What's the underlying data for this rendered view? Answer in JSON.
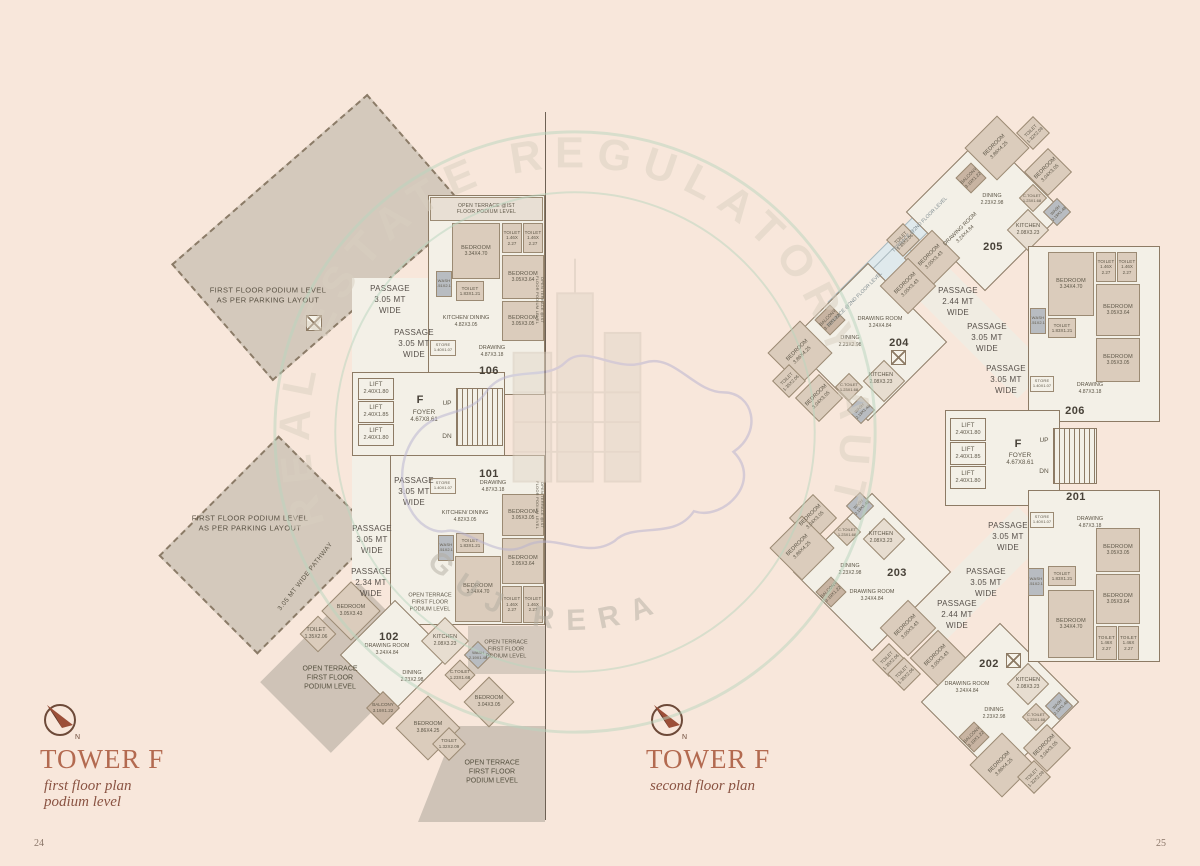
{
  "meta": {
    "page_left": "24",
    "page_right": "25"
  },
  "watermark": {
    "arc": "REAL ESTATE REGULATORY AUTHORITY",
    "bottom": "GUJ RERA"
  },
  "titles": {
    "left": {
      "name": "TOWER F",
      "sub1": "first floor plan",
      "sub2": "podium level"
    },
    "right": {
      "name": "TOWER F",
      "sub1": "second floor plan"
    }
  },
  "labels": {
    "podium": "FIRST FLOOR PODIUM LEVEL\nAS PER PARKING LAYOUT",
    "terrace_strip": "OPEN TERRACE @IST\nFLOOR PODIUM LEVEL",
    "open_terrace": "OPEN TERRACE\nFIRST FLOOR\nPODIUM LEVEL",
    "terrace_2nd": "TERRACE @2ND FLOOR LEVEL",
    "pathway": "3.05 MT WIDE PATHWAY",
    "p305": "PASSAGE\n3.05 MT\nWIDE",
    "p244": "PASSAGE\n2.44 MT\nWIDE",
    "p234": "PASSAGE\n2.34 MT\nWIDE",
    "up": "UP",
    "dn": "DN",
    "f": "F",
    "foyer_n": "FOYER",
    "foyer_d": "4.67X8.61"
  },
  "lifts": {
    "l1": {
      "n": "LIFT",
      "d": "2.40X1.80"
    },
    "l2": {
      "n": "LIFT",
      "d": "2.40X1.85"
    }
  },
  "ro": {
    "drawing": {
      "n": "DRAWING",
      "d": "4.87X3.18"
    },
    "store": {
      "n": "STORE",
      "d": "1.40X1.07"
    },
    "kitchen": {
      "n": "KITCHEN/ DINING",
      "d": "4.82X3.05"
    },
    "wash": {
      "n": "WASH",
      "d": "1.51X2.10"
    },
    "toilet": {
      "n": "TOILET",
      "d": "1.83X1.21"
    },
    "bed1": {
      "n": "BEDROOM",
      "d": "3.05X3.05"
    },
    "bed2": {
      "n": "BEDROOM",
      "d": "3.05X3.64"
    },
    "bed3": {
      "n": "BEDROOM",
      "d": "3.34X4.70"
    },
    "toilet2": {
      "n": "TOILET",
      "d": "1.46X\n2.27"
    }
  },
  "rd": {
    "drawing": {
      "n": "DRAWING ROOM",
      "d": "3.24X4.84"
    },
    "dining": {
      "n": "DINING",
      "d": "2.23X2.98"
    },
    "kitchen": {
      "n": "KITCHEN",
      "d": "2.08X3.23"
    },
    "bed1": {
      "n": "BEDROOM",
      "d": "3.05X3.43"
    },
    "bed2": {
      "n": "BEDROOM",
      "d": "3.86X4.25"
    },
    "bed3": {
      "n": "BEDROOM",
      "d": "3.04X3.05"
    },
    "toilet1": {
      "n": "TOILET",
      "d": "1.35X2.06"
    },
    "toilet2": {
      "n": "TOILET",
      "d": "1.32X2.09"
    },
    "ctoilet": {
      "n": "C.TOILET",
      "d": "1.23X1.68"
    },
    "wash": {
      "n": "WASH",
      "d": "2.19X1.48"
    },
    "balcony": {
      "n": "BALCONY",
      "d": "3.19X1.22"
    }
  },
  "units": {
    "u101": "101",
    "u102": "102",
    "u106": "106",
    "u201": "201",
    "u202": "202",
    "u203": "203",
    "u204": "204",
    "u205": "205",
    "u206": "206"
  }
}
